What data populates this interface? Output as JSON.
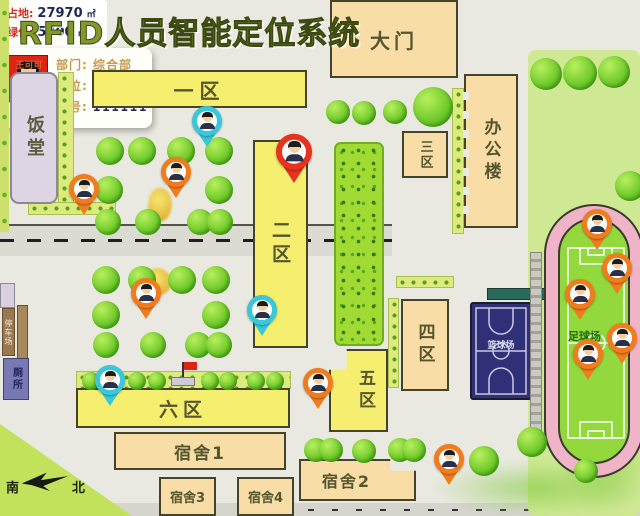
{
  "title": "RFID人员智能定位系统",
  "info_panel": {
    "rows": [
      {
        "label": "占地:",
        "value": "27970",
        "unit": "㎡"
      },
      {
        "label": "绿化:",
        "value": "5700",
        "unit": "㎡"
      }
    ]
  },
  "buildings": {
    "gate": "大门",
    "office": "办公楼",
    "canteen": "饭堂",
    "zone1": "一区",
    "zone2": "二区",
    "zone3": "三区",
    "zone4": "四区",
    "zone5": "五区",
    "zone6": "六区",
    "dorm1": "宿舍1",
    "dorm2": "宿舍2",
    "dorm3": "宿舍3",
    "dorm4": "宿舍4",
    "parking": "停车场",
    "toilet": "厕所",
    "basketball_court": "篮球场",
    "football_field": "足球场"
  },
  "popup": {
    "name": "王可可",
    "fields": [
      {
        "label": "部门:",
        "value": "综合部"
      },
      {
        "label": "职位:",
        "value": "部门经理"
      },
      {
        "label": "工号:",
        "value": "111111"
      }
    ]
  },
  "compass": {
    "south": "南",
    "north": "北"
  },
  "colors": {
    "pin_orange": "#f07c1e",
    "pin_cyan": "#38c8da",
    "pin_red": "#e63320",
    "building_yellow": "#f5ee6e",
    "building_tan": "#f8dda6",
    "track_pink": "#f0b4c8",
    "field_green": "#93d83c",
    "court_navy": "#303078",
    "info_label_red": "#da2c1c"
  },
  "map": {
    "pins": [
      {
        "x": 207,
        "y": 150,
        "color": "cyan"
      },
      {
        "x": 294,
        "y": 187,
        "color": "red",
        "big": true
      },
      {
        "x": 84,
        "y": 218,
        "color": "orange"
      },
      {
        "x": 176,
        "y": 201,
        "color": "orange"
      },
      {
        "x": 146,
        "y": 322,
        "color": "orange"
      },
      {
        "x": 262,
        "y": 339,
        "color": "cyan"
      },
      {
        "x": 110,
        "y": 409,
        "color": "cyan"
      },
      {
        "x": 318,
        "y": 412,
        "color": "orange"
      },
      {
        "x": 449,
        "y": 488,
        "color": "orange"
      },
      {
        "x": 597,
        "y": 253,
        "color": "orange"
      },
      {
        "x": 617,
        "y": 297,
        "color": "orange"
      },
      {
        "x": 580,
        "y": 323,
        "color": "orange"
      },
      {
        "x": 622,
        "y": 367,
        "color": "orange"
      },
      {
        "x": 588,
        "y": 383,
        "color": "orange"
      }
    ],
    "trees": [
      {
        "x": 546,
        "y": 74,
        "r": 16
      },
      {
        "x": 580,
        "y": 73,
        "r": 17
      },
      {
        "x": 614,
        "y": 72,
        "r": 16
      },
      {
        "x": 630,
        "y": 186,
        "r": 15
      },
      {
        "x": 338,
        "y": 112,
        "r": 12
      },
      {
        "x": 364,
        "y": 113,
        "r": 12
      },
      {
        "x": 395,
        "y": 112,
        "r": 12
      },
      {
        "x": 433,
        "y": 107,
        "r": 20
      },
      {
        "x": 110,
        "y": 151,
        "r": 14
      },
      {
        "x": 142,
        "y": 151,
        "r": 14
      },
      {
        "x": 181,
        "y": 151,
        "r": 14
      },
      {
        "x": 219,
        "y": 151,
        "r": 14
      },
      {
        "x": 109,
        "y": 190,
        "r": 14
      },
      {
        "x": 219,
        "y": 190,
        "r": 14
      },
      {
        "x": 108,
        "y": 222,
        "r": 13
      },
      {
        "x": 148,
        "y": 222,
        "r": 13
      },
      {
        "x": 200,
        "y": 222,
        "r": 13
      },
      {
        "x": 220,
        "y": 222,
        "r": 13
      },
      {
        "x": 106,
        "y": 280,
        "r": 14
      },
      {
        "x": 142,
        "y": 280,
        "r": 14
      },
      {
        "x": 182,
        "y": 280,
        "r": 14
      },
      {
        "x": 216,
        "y": 280,
        "r": 14
      },
      {
        "x": 106,
        "y": 315,
        "r": 14
      },
      {
        "x": 216,
        "y": 315,
        "r": 14
      },
      {
        "x": 106,
        "y": 345,
        "r": 13
      },
      {
        "x": 153,
        "y": 345,
        "r": 13
      },
      {
        "x": 198,
        "y": 345,
        "r": 13
      },
      {
        "x": 219,
        "y": 345,
        "r": 13
      },
      {
        "x": 91,
        "y": 381,
        "r": 9
      },
      {
        "x": 137,
        "y": 381,
        "r": 9
      },
      {
        "x": 157,
        "y": 381,
        "r": 9
      },
      {
        "x": 210,
        "y": 381,
        "r": 9
      },
      {
        "x": 228,
        "y": 381,
        "r": 9
      },
      {
        "x": 256,
        "y": 381,
        "r": 9
      },
      {
        "x": 275,
        "y": 381,
        "r": 9
      },
      {
        "x": 316,
        "y": 450,
        "r": 12
      },
      {
        "x": 331,
        "y": 450,
        "r": 12
      },
      {
        "x": 364,
        "y": 451,
        "r": 12
      },
      {
        "x": 400,
        "y": 450,
        "r": 12
      },
      {
        "x": 414,
        "y": 450,
        "r": 12
      },
      {
        "x": 484,
        "y": 461,
        "r": 15
      },
      {
        "x": 532,
        "y": 442,
        "r": 15
      },
      {
        "x": 586,
        "y": 471,
        "r": 12
      }
    ]
  }
}
